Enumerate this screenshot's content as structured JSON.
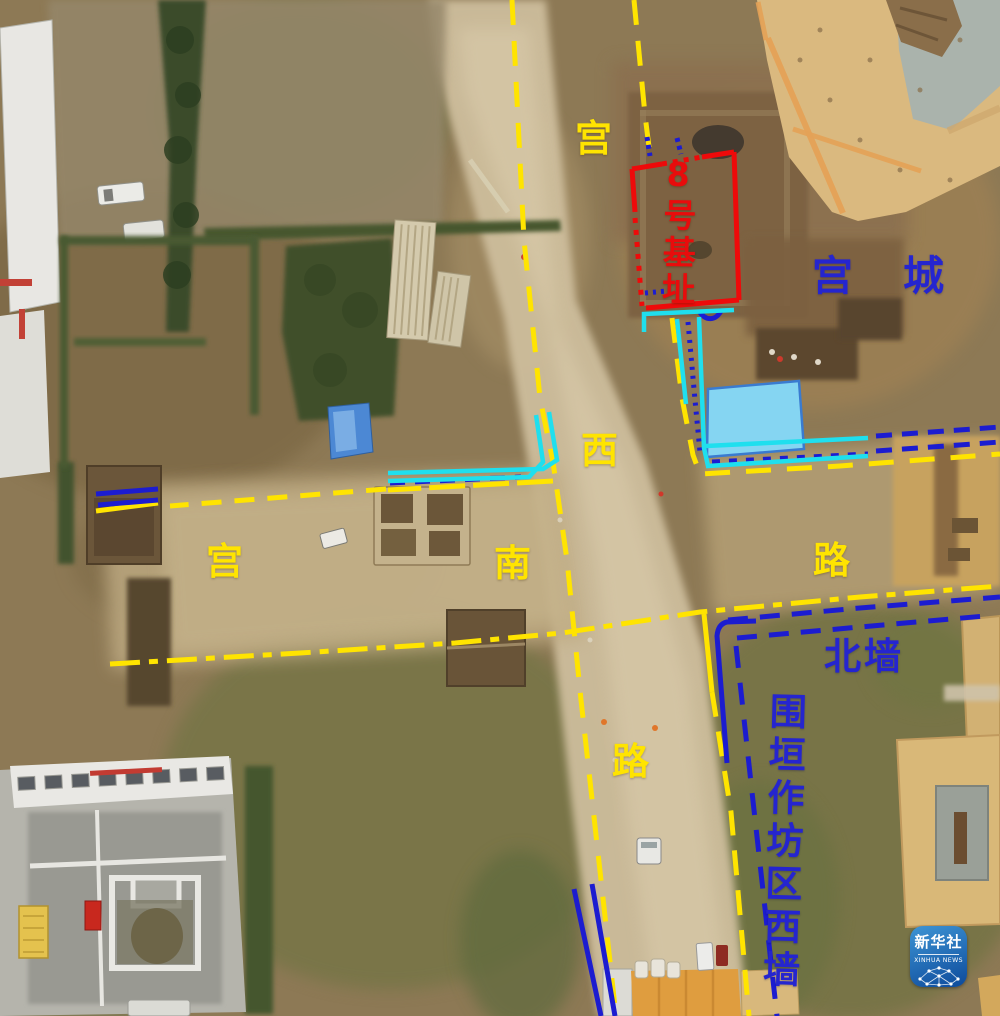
{
  "annotations": {
    "road_west_vertical_chars": [
      "宫",
      "西",
      "路"
    ],
    "road_south_horizontal_chars": [
      "宫",
      "南",
      "路"
    ],
    "site_no8_label": "8号基址",
    "palace_city_label": "宫城",
    "north_wall_label": "北墙",
    "workshop_west_wall_label": "围垣作坊区西墙"
  },
  "watermark": {
    "name_cn": "新华社",
    "name_en": "XINHUA NEWS"
  },
  "legend_colors": {
    "road_line_yellow": "#ffe400",
    "wall_line_blue": "#1c1cd0",
    "trench_line_cyan": "#1fdfee",
    "site_outline_red": "#ee0a0a",
    "highlight_fill_blue": "#85d5f2",
    "watermark_blue": "#0d4a9b"
  }
}
